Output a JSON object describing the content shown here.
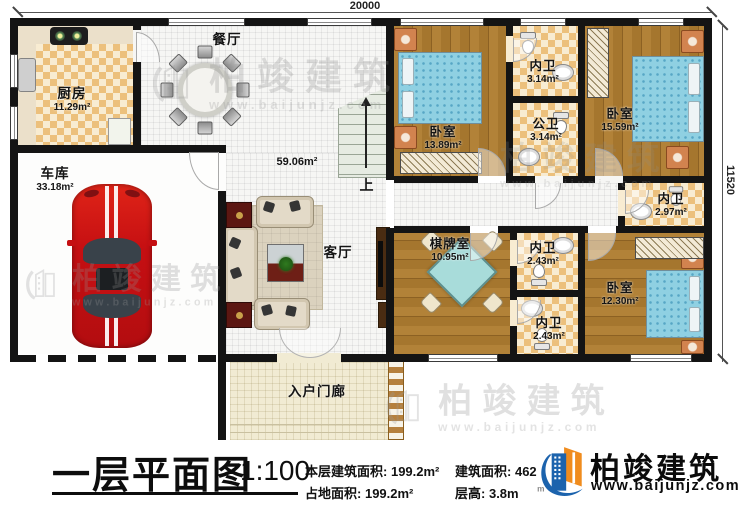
{
  "dimensions": {
    "top": "20000",
    "right": "11520"
  },
  "rooms": {
    "kitchen": {
      "name": "厨房",
      "area": "11.29m²"
    },
    "dining": {
      "name": "餐厅"
    },
    "garage": {
      "name": "车库",
      "area": "33.18m²"
    },
    "living": {
      "name": "客厅"
    },
    "open_area": {
      "area": "59.06m²"
    },
    "bedroom1": {
      "name": "卧室",
      "area": "13.89m²"
    },
    "ensuite1": {
      "name": "内卫",
      "area": "3.14m²"
    },
    "public_bath": {
      "name": "公卫",
      "area": "3.14m²"
    },
    "bedroom2": {
      "name": "卧室",
      "area": "15.59m²"
    },
    "ensuite2": {
      "name": "内卫",
      "area": "2.97m²"
    },
    "chess_room": {
      "name": "棋牌室",
      "area": "10.95m²"
    },
    "ensuite3": {
      "name": "内卫",
      "area": "2.43m²"
    },
    "ensuite4": {
      "name": "内卫",
      "area": "2.43m²"
    },
    "bedroom3": {
      "name": "卧室",
      "area": "12.30m²"
    },
    "porch": {
      "name": "入户门廊"
    }
  },
  "stairs": {
    "up_label": "上"
  },
  "title_block": {
    "title": "一层平面图",
    "scale": "1:100",
    "stat1_label": "本层建筑面积:",
    "stat1_value": "199.2m²",
    "stat2_label": "占地面积:",
    "stat2_value": "199.2m²",
    "stat3_label": "建筑面积:",
    "stat3_value": "462",
    "stat4_label": "层高:",
    "stat4_value": "3.8m"
  },
  "branding": {
    "name": "柏竣建筑",
    "url": "www.baijunjz.com"
  },
  "watermark": {
    "name": "柏竣建筑",
    "url": "www.baijunjz.com"
  },
  "colors": {
    "wall": "#141414",
    "wood_floor": "#a5762e",
    "tile_checker": "#ecc07c",
    "bed_blue": "#8fd0e2",
    "car_red": "#c50f12",
    "brand_blue": "#1a5fa8",
    "brand_orange": "#f08c1e"
  }
}
